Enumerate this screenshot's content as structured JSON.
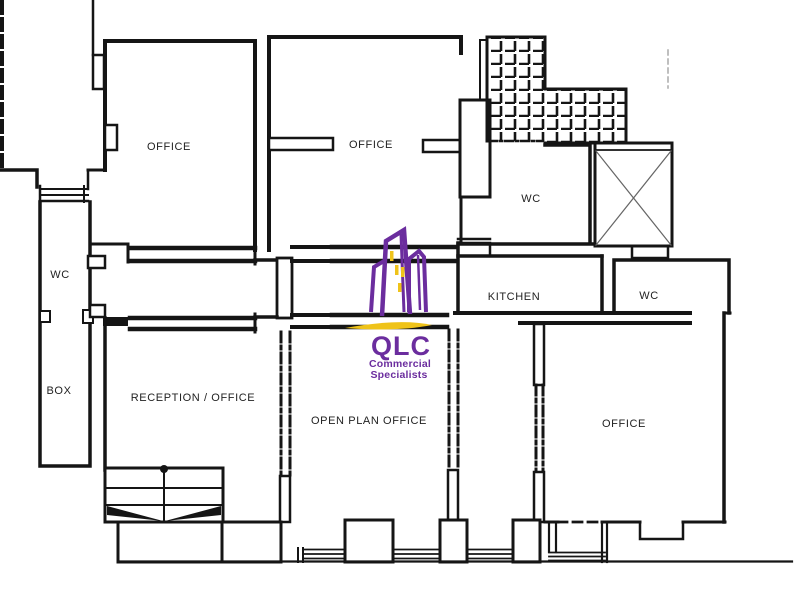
{
  "title": "QLC commercial floor plan",
  "rooms": [
    {
      "id": "office-top-left",
      "label": "OFFICE"
    },
    {
      "id": "office-top-middle",
      "label": "OFFICE"
    },
    {
      "id": "wc-top",
      "label": "WC"
    },
    {
      "id": "wc-left",
      "label": "WC"
    },
    {
      "id": "box",
      "label": "BOX"
    },
    {
      "id": "reception-office",
      "label": "RECEPTION / OFFICE"
    },
    {
      "id": "open-plan-office",
      "label": "OPEN PLAN OFFICE"
    },
    {
      "id": "kitchen",
      "label": "KITCHEN"
    },
    {
      "id": "wc-right",
      "label": "WC"
    },
    {
      "id": "office-right",
      "label": "OFFICE"
    }
  ],
  "logo": {
    "acronym": "QLC",
    "subtitle_line1": "Commercial",
    "subtitle_line2": "Specialists"
  },
  "colors": {
    "wall": "#151515",
    "logo_purple": "#6B2D9E",
    "logo_yellow": "#EFC319",
    "background": "#ffffff"
  }
}
